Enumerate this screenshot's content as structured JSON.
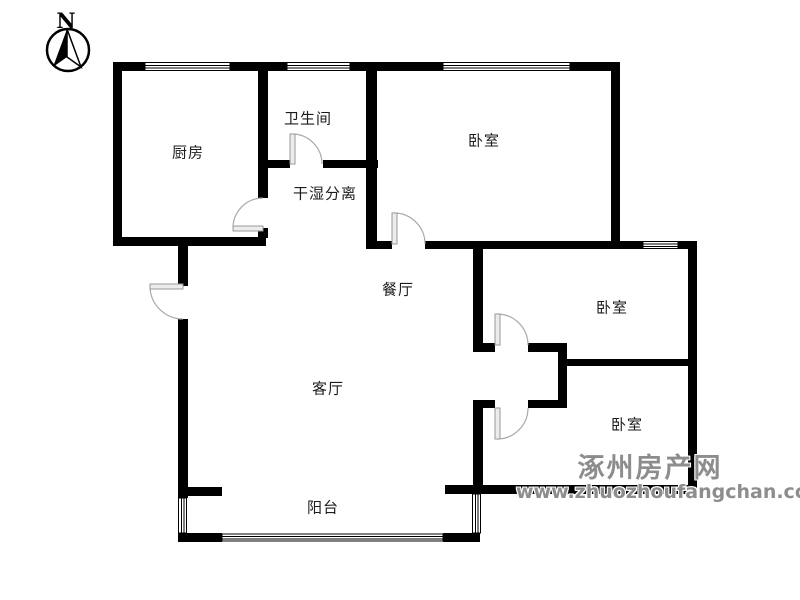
{
  "compass": {
    "north_label": "N"
  },
  "rooms": {
    "kitchen": "厨房",
    "bathroom": "卫生间",
    "dry_wet_separation": "干湿分离",
    "bedroom_top": "卧室",
    "bedroom_middle": "卧室",
    "bedroom_bottom": "卧室",
    "dining": "餐厅",
    "living": "客厅",
    "balcony": "阳台"
  },
  "watermark": {
    "site_name": "涿州房产网",
    "site_url": "www.zhuozhoufangchan.com"
  },
  "colors": {
    "wall": "#000000",
    "door_arc": "#aaaaaa",
    "door_panel": "#ececec",
    "watermark": "#8d8d8d",
    "background": "#ffffff"
  }
}
